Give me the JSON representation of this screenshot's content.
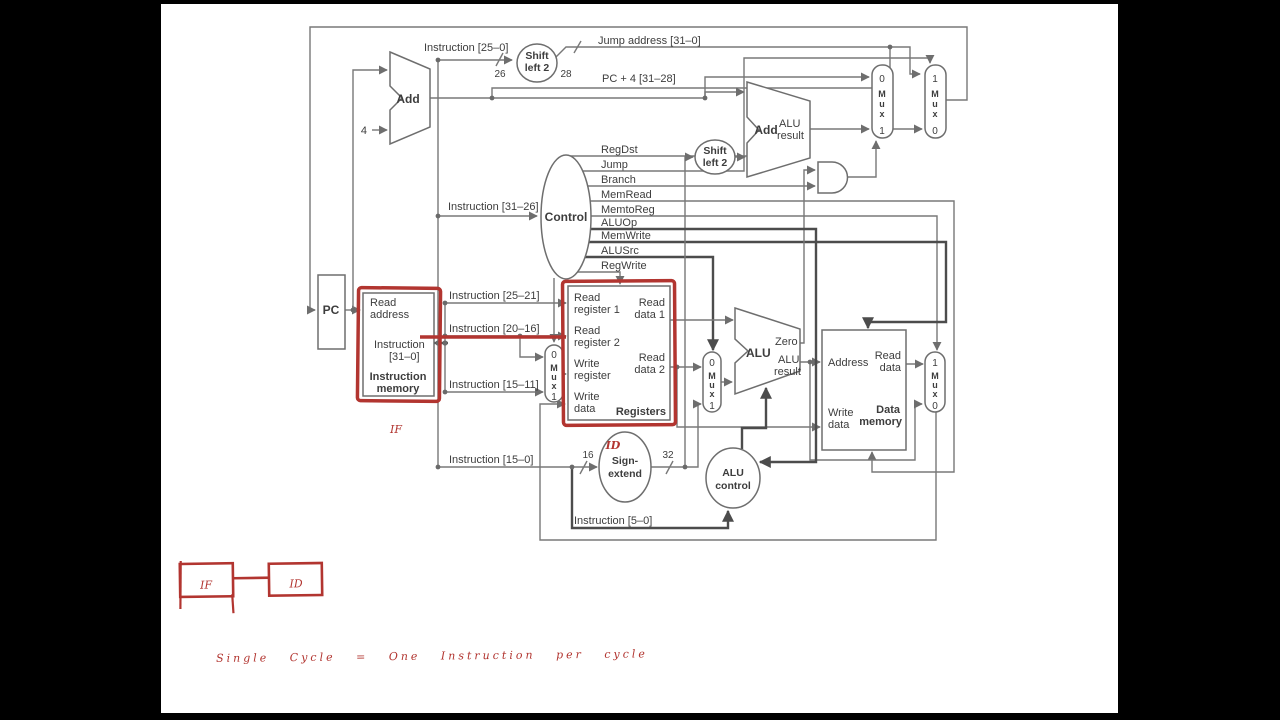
{
  "colors": {
    "letterbox": "#000000",
    "diagram_line": "#787878",
    "diagram_line_dark": "#4c4c4c",
    "annotation_red": "#b23530",
    "background": "#ffffff"
  },
  "diagram": {
    "pc_label": "PC",
    "add_label": "Add",
    "four": "4",
    "instr_25_0": "Instruction [25–0]",
    "bits_26": "26",
    "bits_28": "28",
    "bits_16": "16",
    "bits_32": "32",
    "shift_line1": "Shift",
    "shift_line2": "left 2",
    "jump_addr": "Jump address [31–0]",
    "pc_plus_4": "PC + 4 [31–28]",
    "alu_word": "ALU",
    "result_word": "result",
    "zero": "Zero",
    "mux_m": "M",
    "mux_u": "u",
    "mux_x": "x",
    "zero_str": "0",
    "one_str": "1",
    "control": "Control",
    "control_lower": "control",
    "signals": [
      "RegDst",
      "Jump",
      "Branch",
      "MemRead",
      "MemtoReg",
      "ALUOp",
      "MemWrite",
      "ALUSrc",
      "RegWrite"
    ],
    "instr_31_26": "Instruction [31–26]",
    "instr_25_21": "Instruction [25–21]",
    "instr_20_16": "Instruction [20–16]",
    "instr_15_11": "Instruction [15–11]",
    "instr_15_0": "Instruction [15–0]",
    "instr_5_0": "Instruction [5–0]",
    "sign1": "Sign-",
    "sign2": "extend",
    "imem": {
      "l1": "Read",
      "l2": "address",
      "l3": "Instruction",
      "l4": "[31–0]",
      "l5": "Instruction",
      "l6": "memory"
    },
    "regs": {
      "rr1a": "Read",
      "rr1b": "register 1",
      "rr2a": "Read",
      "rr2b": "register 2",
      "wra": "Write",
      "wrb": "register",
      "wda": "Write",
      "wdb": "data",
      "rd1a": "Read",
      "rd1b": "data 1",
      "rd2a": "Read",
      "rd2b": "data 2",
      "title": "Registers"
    },
    "dmem": {
      "addr": "Address",
      "rda": "Read",
      "rdb": "data",
      "wra": "Write",
      "wrb": "data",
      "t1": "Data",
      "t2": "memory"
    }
  },
  "handwriting": {
    "if_stage": "IF",
    "id_stage": "ID",
    "box_if": "IF",
    "box_id": "ID",
    "sentence": "Single Cycle = One Instruction per cycle"
  }
}
